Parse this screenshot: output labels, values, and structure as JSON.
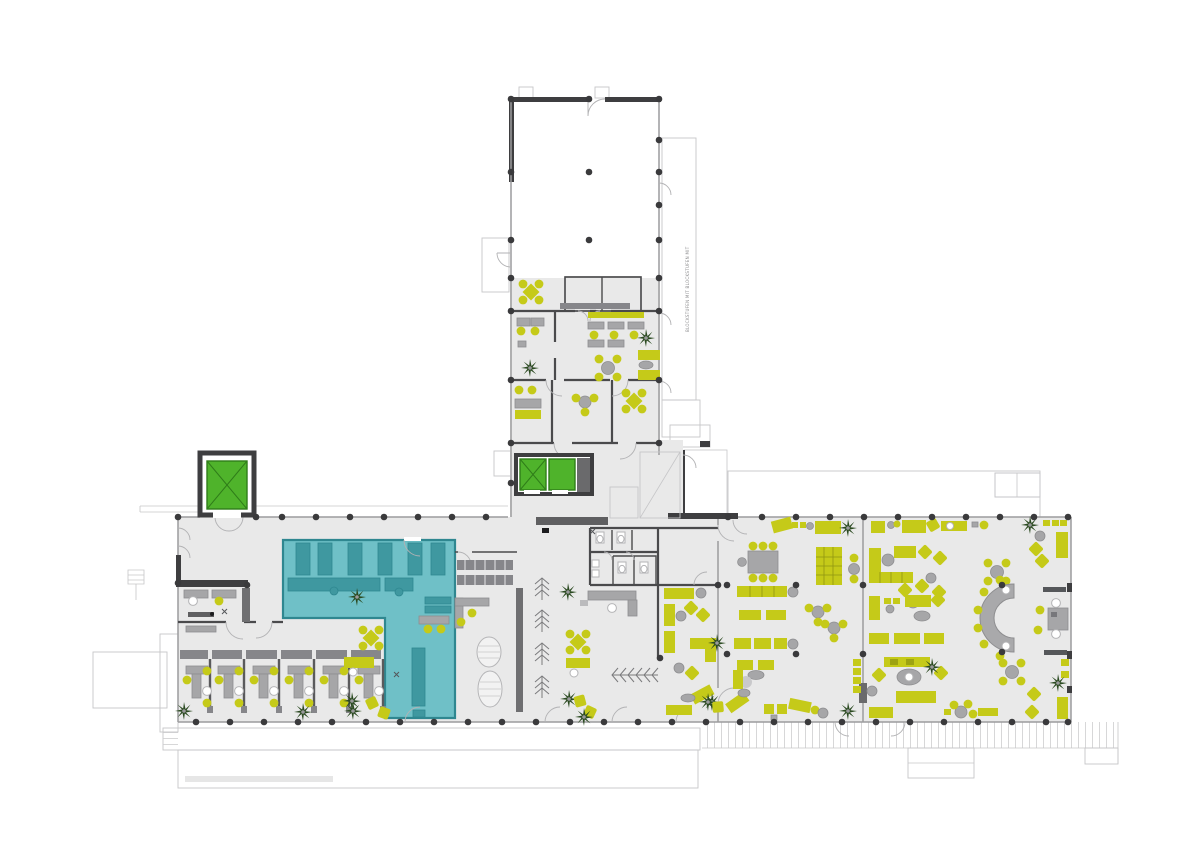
{
  "document": {
    "type": "architectural-floor-plan",
    "page_background": "#ffffff"
  },
  "annotations": {
    "stair_note_vertical": "BLOCKSTUFEN MIT BLOCKSTUFEN MIT"
  },
  "colors": {
    "floor": "#e9e9e9",
    "wall_dark": "#3e3e40",
    "wall_mid": "#4a4a4c",
    "wall_light": "#9c9c9e",
    "outline": "#c6c6c8",
    "teal": "#6fc0c7",
    "teal_dark": "#3f98a0",
    "teal_border": "#2f8790",
    "green": "#c5ca19",
    "green_border": "#8f9511",
    "green_dark": "#9da311",
    "gray_furniture": "#a6a6a8",
    "gray_dark": "#86868a",
    "plant_green": "#2b4a21",
    "elevator_green": "#4fb32b",
    "elevator_dark": "#2f7d19",
    "column": "#3a3a3c"
  }
}
